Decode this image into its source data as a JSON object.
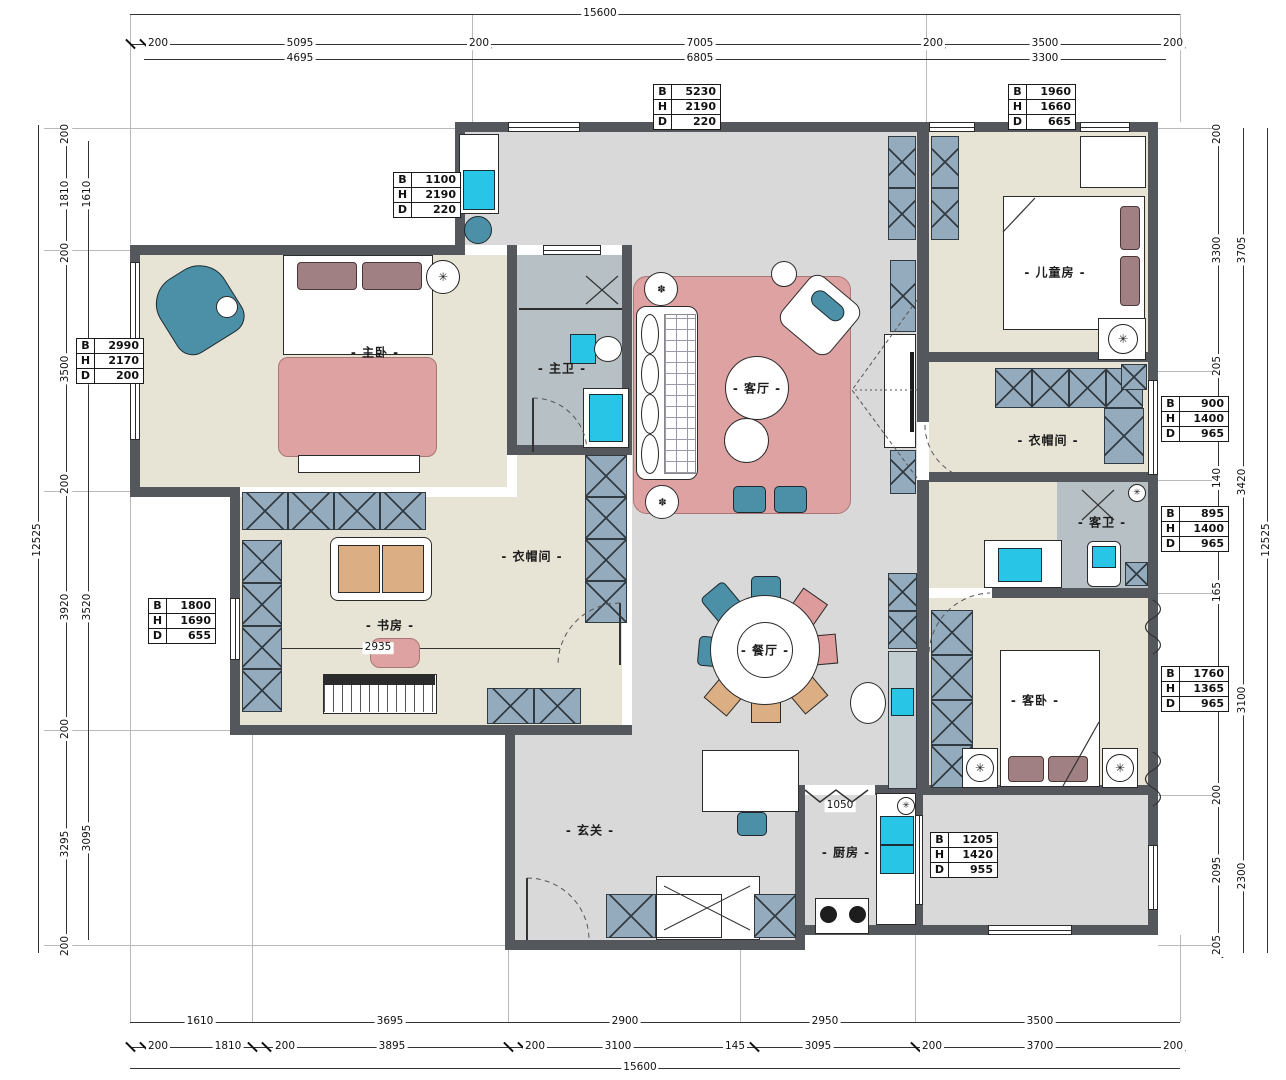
{
  "drawing": {
    "type": "apartment-floor-plan"
  },
  "rooms": {
    "master_bedroom": "- 主卧 -",
    "master_bath": "- 主卫 -",
    "living": "- 客厅 -",
    "children_room": "- 儿童房 -",
    "cloak_right": "- 衣帽间 -",
    "guest_bath": "- 客卫 -",
    "cloak_left": "- 衣帽间 -",
    "study": "- 书房 -",
    "dining": "- 餐厅 -",
    "guest_bedroom": "- 客卧 -",
    "foyer": "- 玄关 -",
    "kitchen": "- 厨房 -"
  },
  "inline_dims": {
    "study_width": "2935",
    "kitchen_opening": "1050"
  },
  "bhd_labels": {
    "b": "B",
    "h": "H",
    "d": "D"
  },
  "cabinet_tables": {
    "t1": {
      "b": "1100",
      "h": "2190",
      "d": "220"
    },
    "t2": {
      "b": "5230",
      "h": "2190",
      "d": "220"
    },
    "t3": {
      "b": "1960",
      "h": "1660",
      "d": "665"
    },
    "t4": {
      "b": "2990",
      "h": "2170",
      "d": "200"
    },
    "t5": {
      "b": "1800",
      "h": "1690",
      "d": "655"
    },
    "t6": {
      "b": "900",
      "h": "1400",
      "d": "965"
    },
    "t7": {
      "b": "895",
      "h": "1400",
      "d": "965"
    },
    "t8": {
      "b": "1760",
      "h": "1365",
      "d": "965"
    },
    "t9": {
      "b": "1205",
      "h": "1420",
      "d": "955"
    }
  },
  "dims": {
    "top": {
      "total": "15600",
      "chain": [
        "200",
        "5095",
        "200",
        "7005",
        "200",
        "3500",
        "200"
      ],
      "inner": [
        "4695",
        "6805",
        "3300"
      ]
    },
    "bottom": {
      "inner": [
        "1610",
        "3695",
        "2900",
        "2950",
        "3500"
      ],
      "chain": [
        "200",
        "1810",
        "200",
        "3895",
        "200",
        "3100",
        "145",
        "3095",
        "200",
        "3700",
        "200"
      ],
      "total": "15600"
    },
    "left": {
      "total": "12525",
      "chain": [
        "200",
        "1810",
        "200",
        "3500",
        "200",
        "3920",
        "200",
        "3295",
        "200"
      ],
      "inner": [
        "1610",
        "3300",
        "3520",
        "3095"
      ]
    },
    "right": {
      "chain": [
        "200",
        "3300",
        "205",
        "1570",
        "140",
        "1545",
        "165",
        "2900",
        "200",
        "2095",
        "205"
      ],
      "inner": [
        "3705",
        "3420",
        "3100",
        "2300"
      ],
      "total": "12525"
    }
  },
  "colors": {
    "wall": "#54585c",
    "floor_gray": "#d9d9d9",
    "floor_beige": "#e7e3d5",
    "floor_bath": "#b7c1c5",
    "rug_pink": "#dfa2a2",
    "teal": "#4b90a6",
    "fixture_cyan": "#29c5e6",
    "chair_tan": "#dcae83",
    "pillow_mauve": "#a08082",
    "cabinet_hatch": "#93abbd"
  }
}
